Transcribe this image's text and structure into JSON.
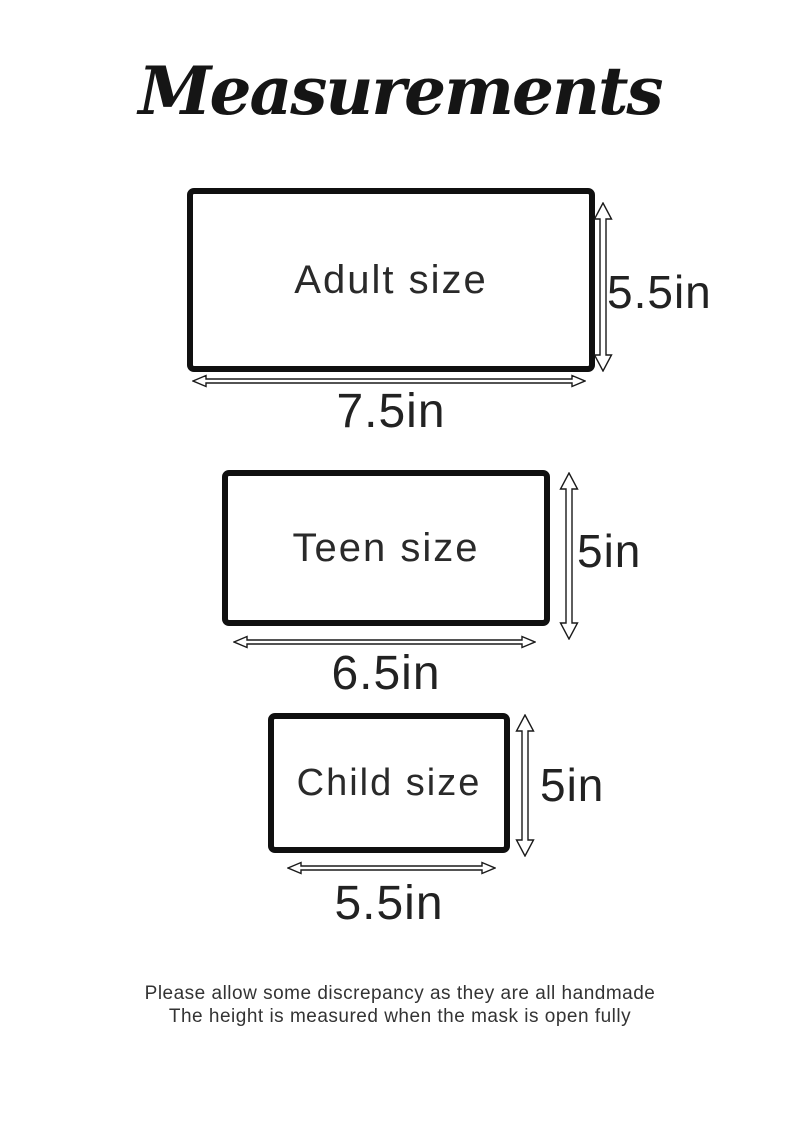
{
  "title": "Measurements",
  "sizes": [
    {
      "name": "Adult size",
      "width": "7.5in",
      "height": "5.5in"
    },
    {
      "name": "Teen size",
      "width": "6.5in",
      "height": "5in"
    },
    {
      "name": "Child size",
      "width": "5.5in",
      "height": "5in"
    }
  ],
  "footer": {
    "line1": "Please allow some discrepancy as they are all handmade",
    "line2": "The height is measured when the mask is open fully"
  },
  "colors": {
    "ink": "#1a1a1a",
    "background": "#ffffff"
  }
}
